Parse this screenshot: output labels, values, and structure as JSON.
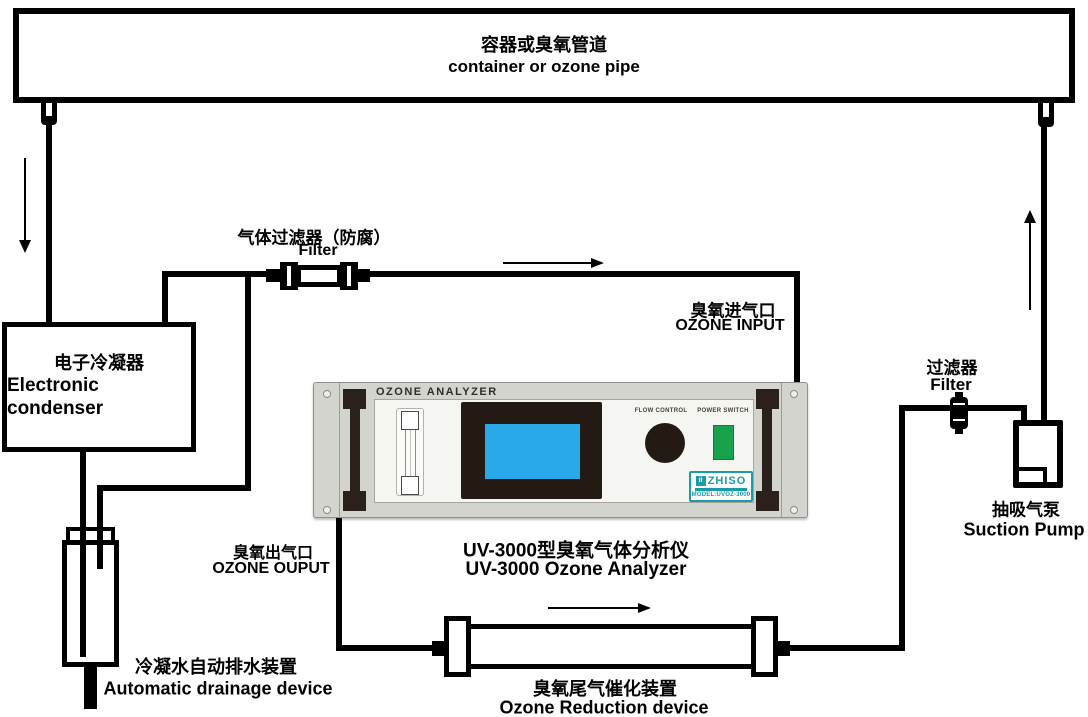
{
  "labels": {
    "container": {
      "zh": "容器或臭氧管道",
      "en": "container or ozone pipe"
    },
    "gas_filter": {
      "zh": "气体过滤器（防腐）",
      "en": "Filter"
    },
    "condenser": {
      "zh": "电子冷凝器",
      "en": "Electronic condenser"
    },
    "ozone_input": {
      "zh": "臭氧进气口",
      "en": "OZONE INPUT"
    },
    "right_filter": {
      "zh": "过滤器",
      "en": "Filter"
    },
    "suction_pump": {
      "zh": "抽吸气泵",
      "en": "Suction Pump"
    },
    "ozone_output": {
      "zh": "臭氧出气口",
      "en": "OZONE OUPUT"
    },
    "analyzer_caption": {
      "zh": "UV-3000型臭氧气体分析仪",
      "en": "UV-3000 Ozone Analyzer"
    },
    "drainage": {
      "zh": "冷凝水自动排水装置",
      "en": "Automatic drainage device"
    },
    "reduction": {
      "zh": "臭氧尾气催化装置",
      "en": "Ozone Reduction device"
    }
  },
  "analyzer_panel": {
    "title": "OZONE ANALYZER",
    "flow_control_label": "FLOW CONTROL",
    "power_switch_label": "POWER SWITCH",
    "logo_brand": "ZHISO",
    "logo_model": "MODEL:UVOZ-3000"
  },
  "arrows": {
    "container_to_condenser": "arrow-down",
    "filter_to_analyzer": "arrow-right",
    "pump_to_container": "arrow-up",
    "output_to_reduction": "arrow-right"
  },
  "colors": {
    "pipe_black": "#000000",
    "panel_gray": "#d3d4ce",
    "screen_blue": "#29a9e8",
    "switch_green": "#17a24b",
    "logo_teal": "#1b9aaa",
    "bezel_black": "#241a14"
  }
}
